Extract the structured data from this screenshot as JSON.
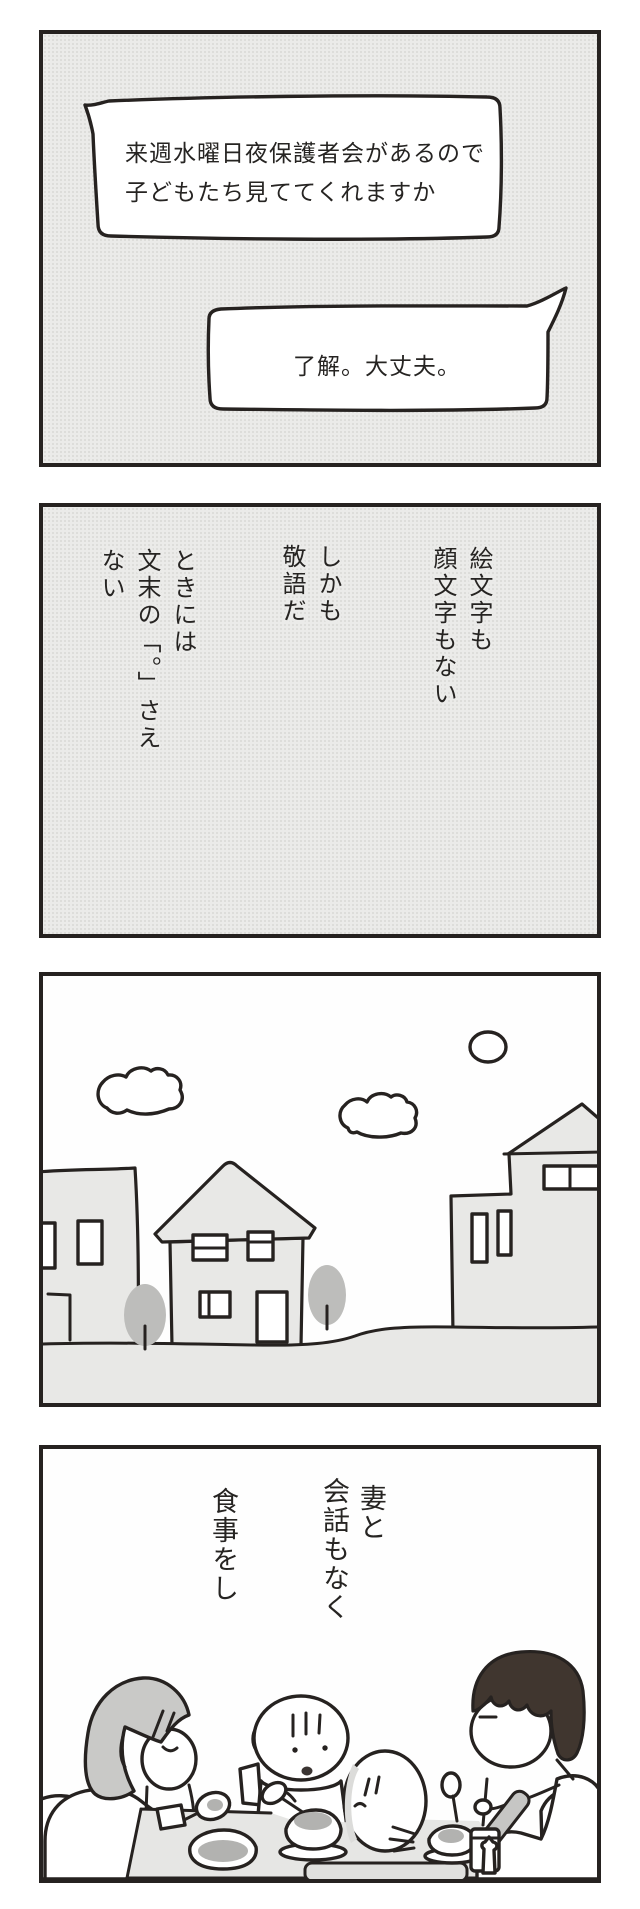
{
  "comic": {
    "panel1": {
      "bubble_left": {
        "line1": "来週水曜日夜保護者会があるので",
        "line2": "子どもたち見ててくれますか"
      },
      "bubble_right": {
        "text": "了解。大丈夫。"
      }
    },
    "panel2": {
      "phrase1_col1": "絵文字も",
      "phrase1_col2": "顔文字もない",
      "phrase2_col1": "しかも",
      "phrase2_col2": "敬語だ",
      "phrase3_col1": "ときには",
      "phrase3_col2": "文末の「。」さえ",
      "phrase3_col3": "ない"
    },
    "panel4": {
      "phrase1_col1": "妻と",
      "phrase1_col2": "会話もなく",
      "phrase2": "食事をし"
    },
    "colors": {
      "panel_background_gray": "#ebebe9",
      "outline_black": "#262220",
      "building_gray": "#e8e8e6",
      "tree_gray": "#bdbdbb",
      "wife_hair_gray": "#c9c9c7",
      "husband_hair_dark": "#40362f",
      "food_gray": "#b2b2b0",
      "table_gray": "#e6e6e4"
    }
  }
}
